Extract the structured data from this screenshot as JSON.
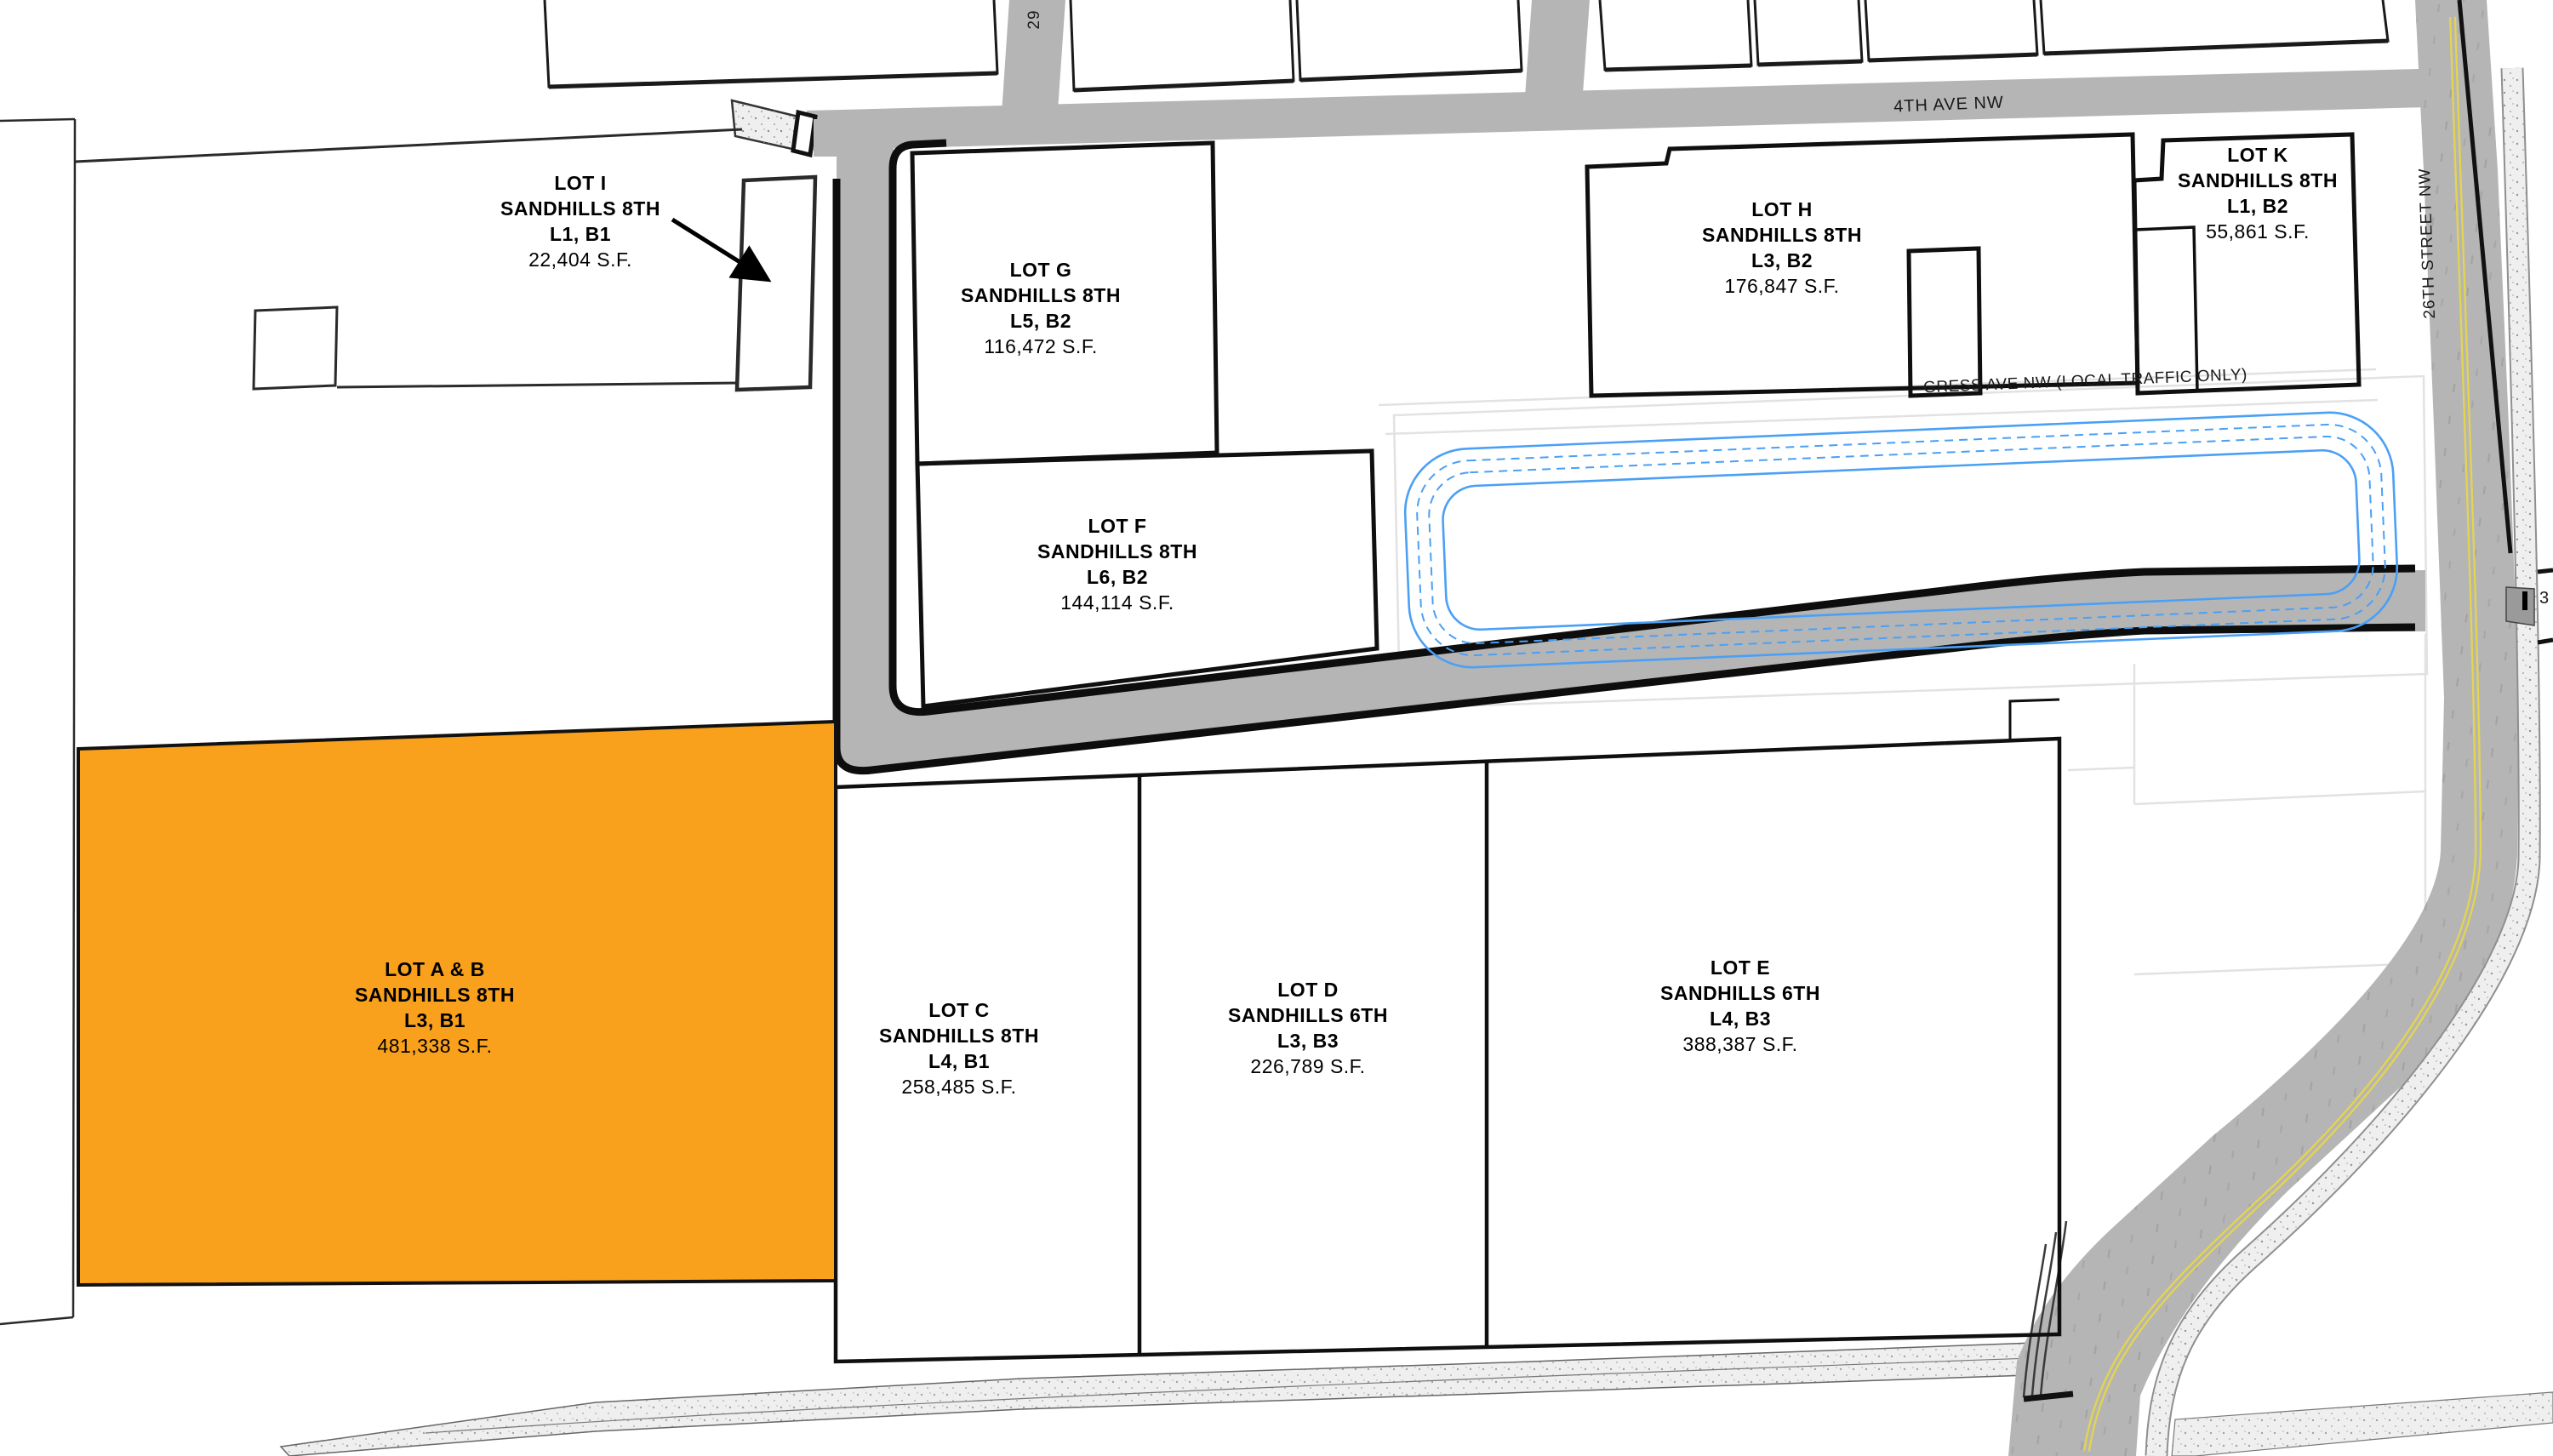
{
  "map": {
    "description": "Sandhills subdivision plat map with lot lines, streets and highlighted parcel",
    "highlight_color": "#F9A11C",
    "road_color": "#B5B5B5",
    "contour_color": "#4AA0F5",
    "lots": {
      "i": {
        "name": "LOT I",
        "plat": "SANDHILLS 8TH",
        "parcel": "L1, B1",
        "area": "22,404 S.F."
      },
      "g": {
        "name": "LOT G",
        "plat": "SANDHILLS 8TH",
        "parcel": "L5, B2",
        "area": "116,472 S.F."
      },
      "h": {
        "name": "LOT H",
        "plat": "SANDHILLS 8TH",
        "parcel": "L3, B2",
        "area": "176,847 S.F."
      },
      "k": {
        "name": "LOT K",
        "plat": "SANDHILLS 8TH",
        "parcel": "L1, B2",
        "area": "55,861 S.F."
      },
      "f": {
        "name": "LOT F",
        "plat": "SANDHILLS 8TH",
        "parcel": "L6, B2",
        "area": "144,114 S.F."
      },
      "ab": {
        "name": "LOT A & B",
        "plat": "SANDHILLS 8TH",
        "parcel": "L3, B1",
        "area": "481,338 S.F.",
        "highlighted": true
      },
      "c": {
        "name": "LOT C",
        "plat": "SANDHILLS 8TH",
        "parcel": "L4, B1",
        "area": "258,485 S.F."
      },
      "d": {
        "name": "LOT D",
        "plat": "SANDHILLS 6TH",
        "parcel": "L3, B3",
        "area": "226,789 S.F."
      },
      "e": {
        "name": "LOT E",
        "plat": "SANDHILLS 6TH",
        "parcel": "L4, B3",
        "area": "388,387 S.F."
      }
    },
    "streets": {
      "ave4": "4TH AVE NW",
      "st26": "26TH STREET NW",
      "gress": "GRESS AVE NW (LOCAL TRAFFIC ONLY)",
      "st29": "29"
    },
    "markers": {
      "right_edge": "3"
    }
  }
}
